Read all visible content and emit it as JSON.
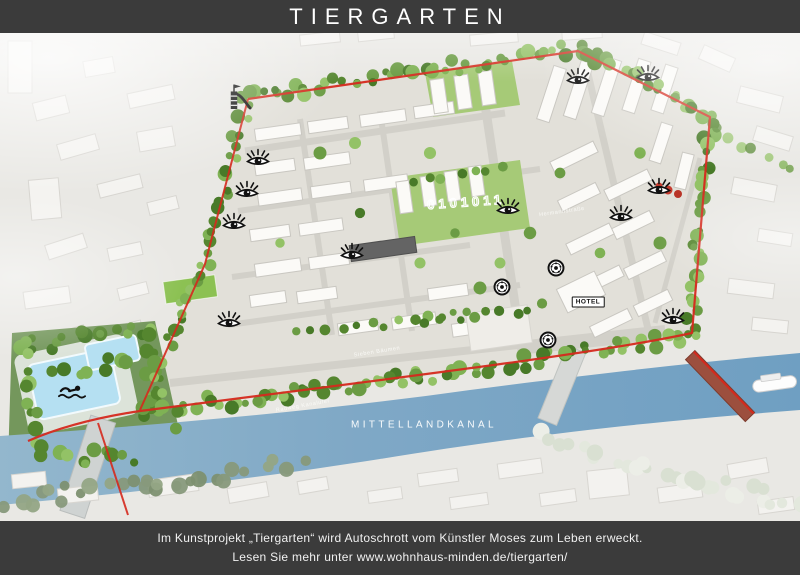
{
  "header": {
    "title": "TIERGARTEN"
  },
  "footer": {
    "line1": "Im Kunstprojekt „Tiergarten“ wird Autoschrott vom Künstler Moses zum Leben erweckt.",
    "line2": "Lesen Sie mehr unter www.wohnhaus-minden.de/tiergarten/"
  },
  "map": {
    "canal_label": "MITTELLANDKANAL",
    "canal_pos": {
      "x": 424,
      "y": 392
    },
    "hotel_label": "HOTEL",
    "hotel_pos": {
      "x": 588,
      "y": 269
    },
    "binary_label": "0101011",
    "binary_pos": {
      "x": 466,
      "y": 169,
      "rotate": -4
    },
    "street_labels": [
      {
        "text": "Sieben Bäumen",
        "x": 377,
        "y": 319,
        "rotate": -9
      },
      {
        "text": "Hermannstraße",
        "x": 562,
        "y": 179,
        "rotate": -8
      },
      {
        "text": "Radweg Kanalufer",
        "x": 303,
        "y": 373,
        "rotate": -10
      }
    ],
    "viewpoint_icons": [
      {
        "x": 258,
        "y": 125
      },
      {
        "x": 247,
        "y": 157
      },
      {
        "x": 234,
        "y": 189
      },
      {
        "x": 229,
        "y": 287
      },
      {
        "x": 352,
        "y": 219
      },
      {
        "x": 508,
        "y": 174
      },
      {
        "x": 578,
        "y": 44
      },
      {
        "x": 648,
        "y": 41
      },
      {
        "x": 659,
        "y": 154
      },
      {
        "x": 621,
        "y": 181
      },
      {
        "x": 673,
        "y": 284
      }
    ],
    "wheel_icons": [
      {
        "x": 556,
        "y": 235
      },
      {
        "x": 502,
        "y": 254
      },
      {
        "x": 548,
        "y": 307
      }
    ],
    "slide_icon": {
      "x": 240,
      "y": 64
    },
    "swimmer_icon": {
      "x": 72,
      "y": 359
    },
    "colors": {
      "bar_background": "#3b3b3b",
      "route_red": "#d5291d",
      "canal_blue": "#7fa8c6",
      "tree_green": "#6b9c44",
      "pool_blue": "#b5e0f2",
      "icon_black": "#111111"
    }
  }
}
